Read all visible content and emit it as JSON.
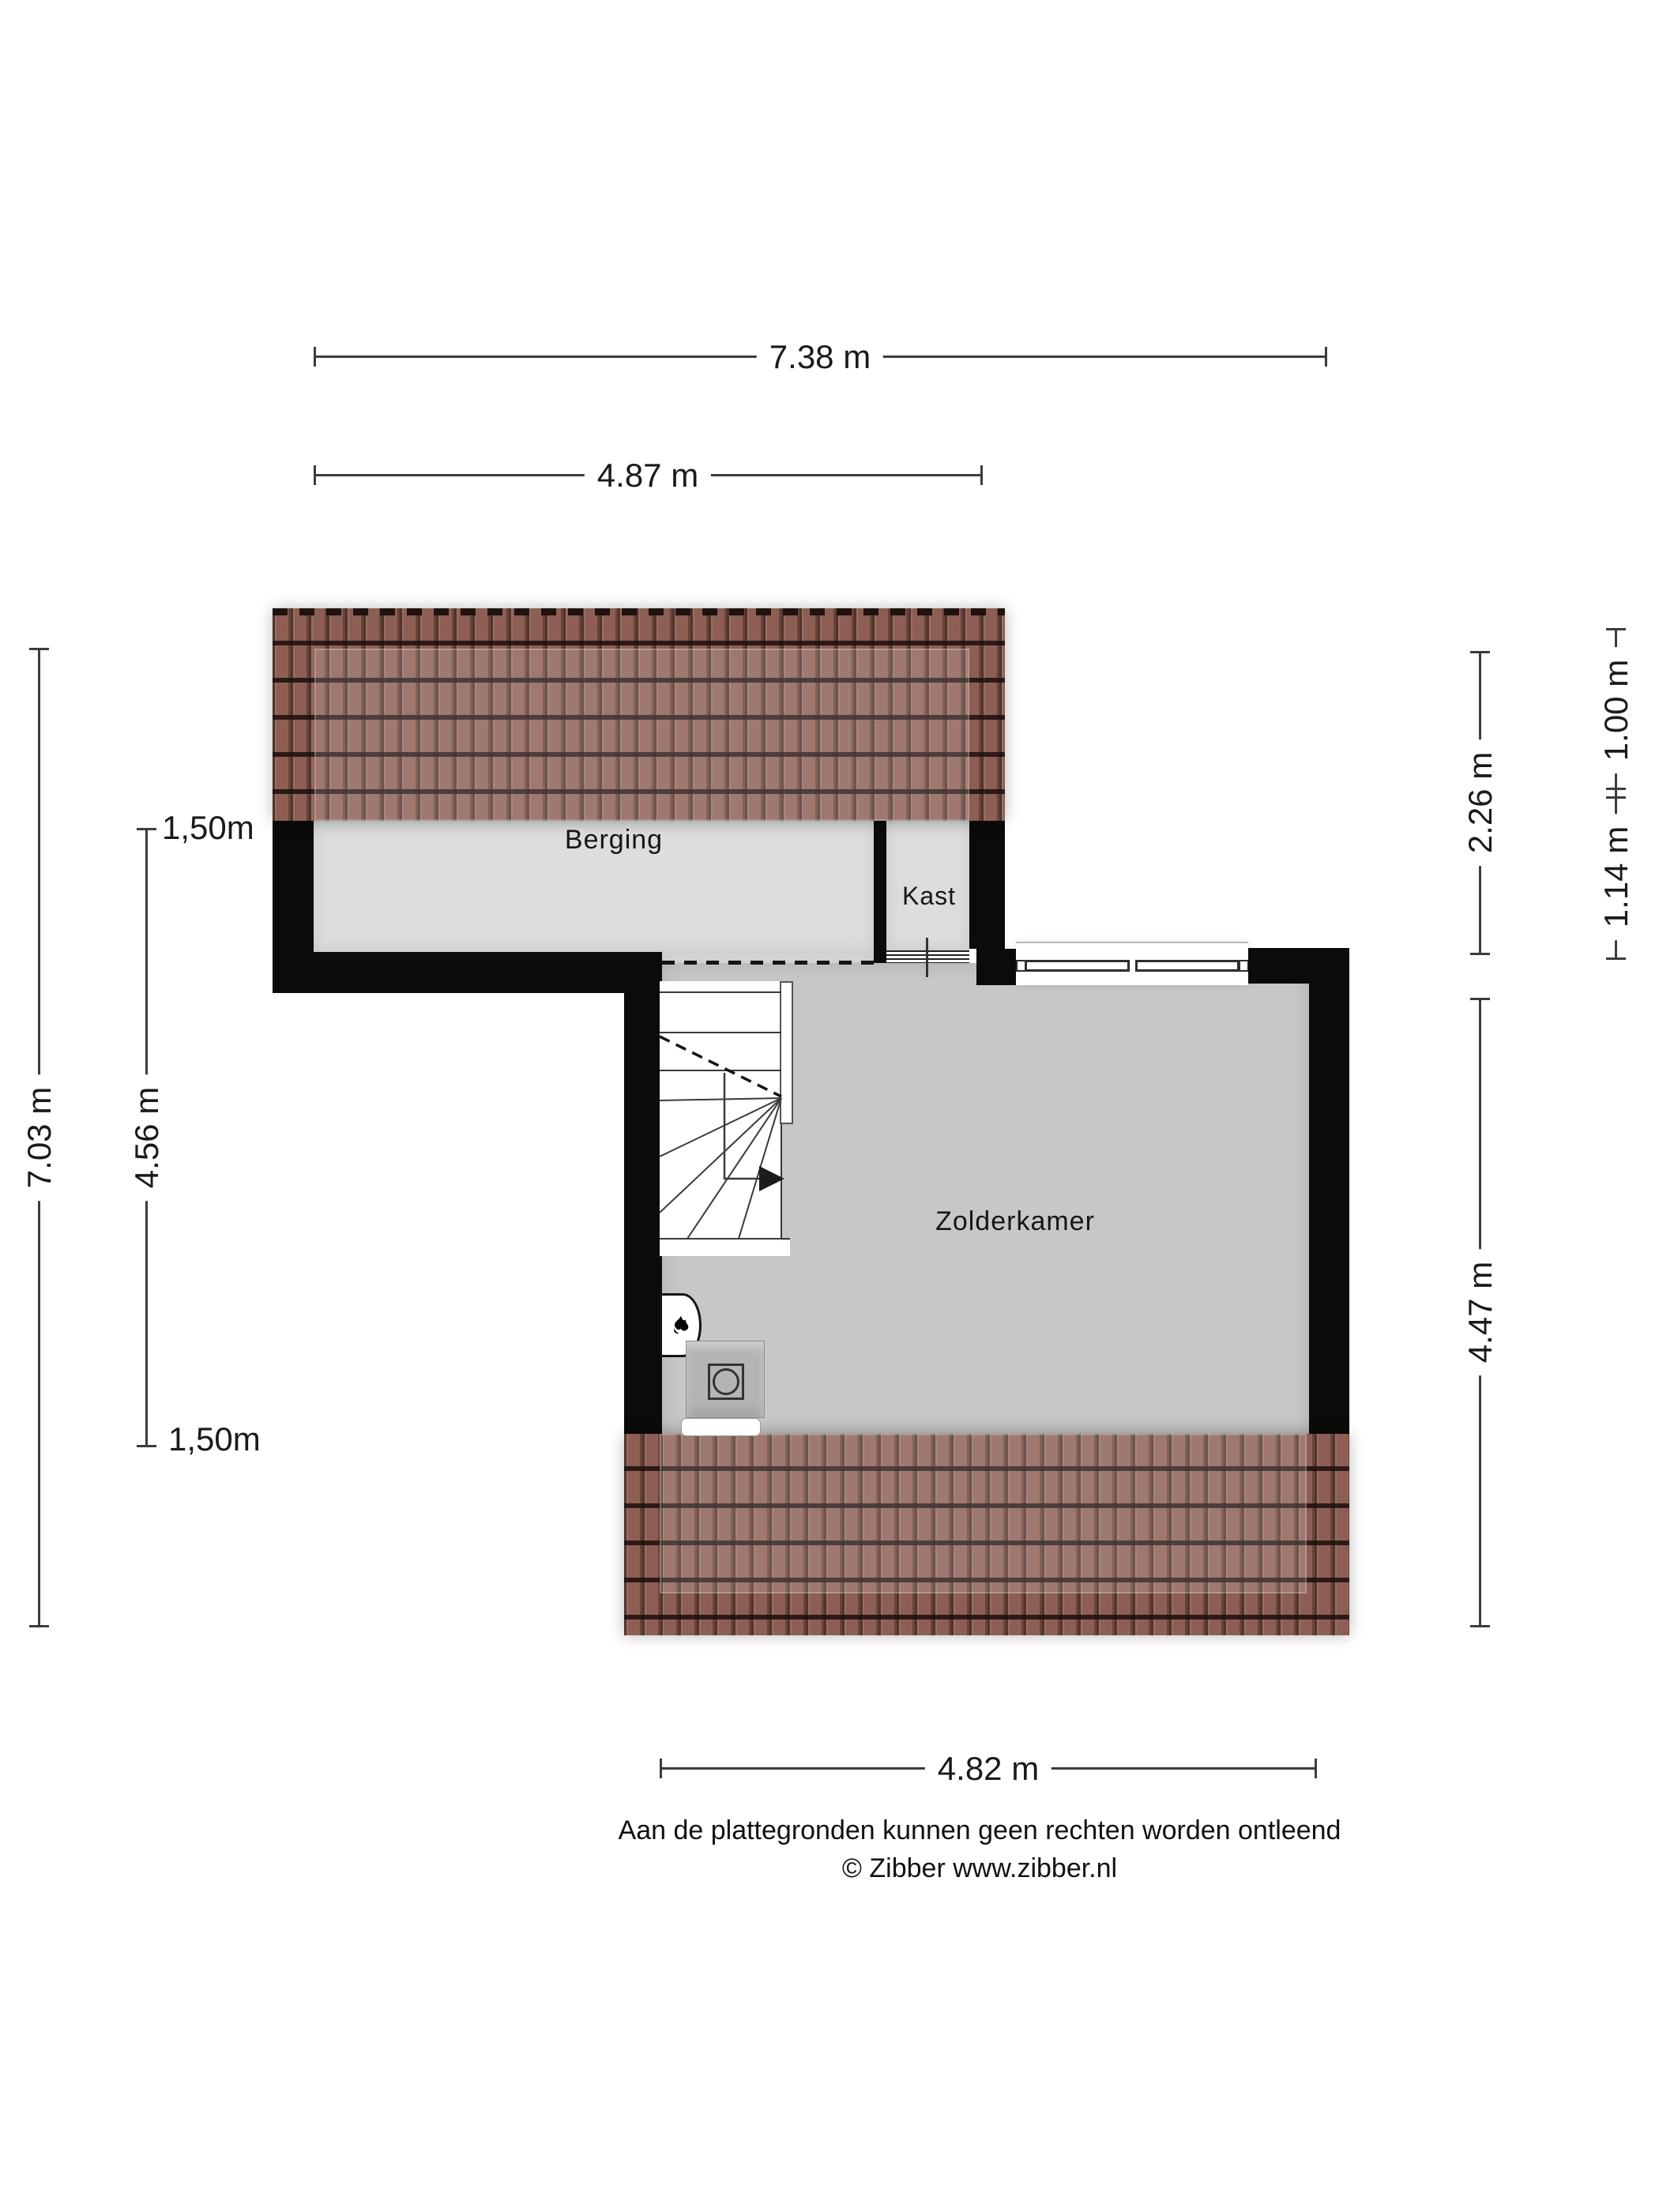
{
  "plan": {
    "type": "floorplan-attic",
    "rooms": {
      "berging": {
        "label": "Berging"
      },
      "kast": {
        "label": "Kast"
      },
      "zolderkamer": {
        "label": "Zolderkamer"
      }
    }
  },
  "dimensions": {
    "top_total": {
      "label": "7.38 m"
    },
    "top_berging": {
      "label": "4.87 m"
    },
    "left_total": {
      "label": "7.03 m"
    },
    "left_inner": {
      "label": "4.56 m"
    },
    "left_clearance_top": {
      "label": "1,50m"
    },
    "left_clearance_bottom": {
      "label": "1,50m"
    },
    "right_upper": {
      "label": "2.26 m"
    },
    "right_lower": {
      "label": "4.47 m"
    },
    "right_outer_top": {
      "label": "1.00 m"
    },
    "right_outer_bottom": {
      "label": "1.14 m"
    },
    "bottom_zolder": {
      "label": "4.82 m"
    }
  },
  "footer": {
    "disclaimer": "Aan de plattegronden kunnen geen rechten worden ontleend",
    "copyright": "© Zibber www.zibber.nl"
  },
  "icons": {
    "boiler": "boiler-flame-icon",
    "washer": "washing-machine-icon",
    "stairs_arrow": "stairs-direction-arrow-icon"
  },
  "colors": {
    "wall": "#0b0b0b",
    "floor_light": "#dcdddd",
    "floor_dark": "#c6c7c8",
    "roof_base": "#8d5f54",
    "dim_line": "#3c3c3c",
    "text": "#1a1a1a"
  }
}
